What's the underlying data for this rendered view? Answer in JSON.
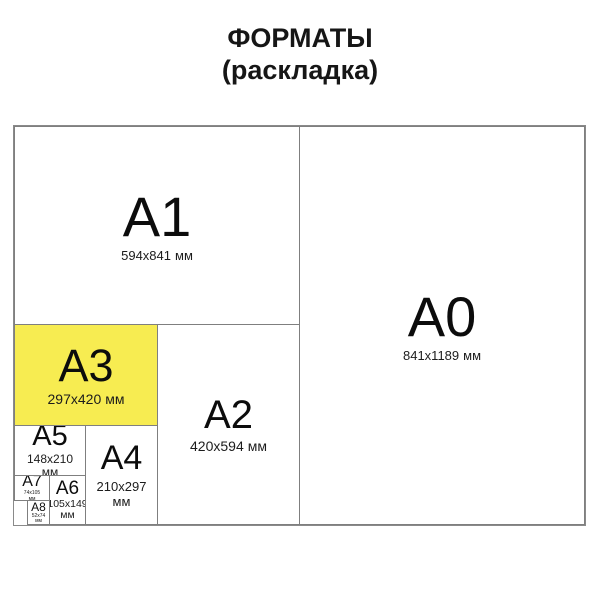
{
  "title": {
    "line1": "ФОРМАТЫ",
    "line2": "(раскладка)"
  },
  "colors": {
    "highlight_yellow": "#F7EC51",
    "border_gray": "#8A8A8A",
    "text_black": "#101010"
  },
  "formats": {
    "a0": {
      "label": "A0",
      "size": "841x1189",
      "unit": "мм"
    },
    "a1": {
      "label": "A1",
      "size": "594x841",
      "unit": "мм"
    },
    "a2": {
      "label": "A2",
      "size": "420x594",
      "unit": "мм"
    },
    "a3": {
      "label": "A3",
      "size": "297x420",
      "unit": "мм"
    },
    "a4": {
      "label": "A4",
      "size": "210x297",
      "unit": "мм"
    },
    "a5": {
      "label": "A5",
      "size": "148x210",
      "unit": "мм"
    },
    "a6": {
      "label": "A6",
      "size": "105x149",
      "unit": "мм"
    },
    "a7": {
      "label": "A7",
      "size": "74x105",
      "unit": "мм"
    },
    "a8": {
      "label": "A8",
      "size": "52x74",
      "unit": "мм"
    }
  }
}
